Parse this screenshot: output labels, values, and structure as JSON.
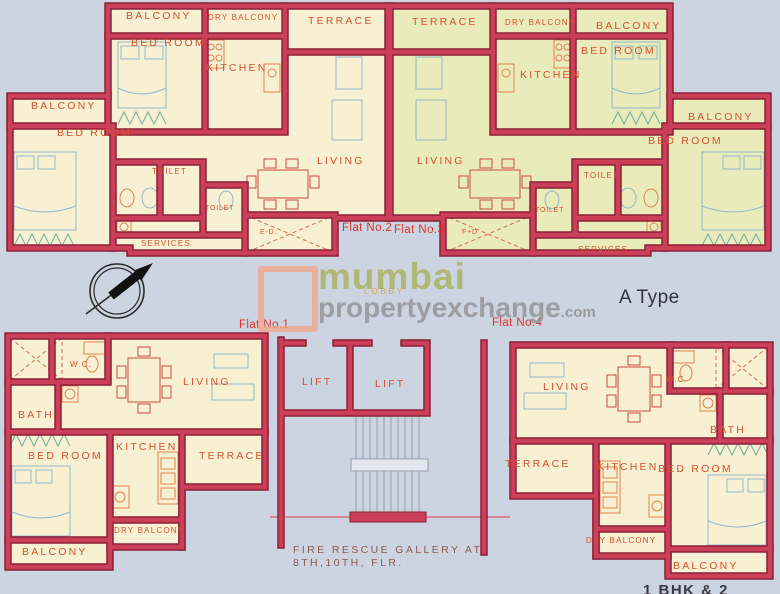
{
  "page": {
    "type_label": "A Type",
    "bottom_caption": "1 BHK & 2",
    "lobby": "LOBBY"
  },
  "watermark": {
    "word1": "mumbai",
    "word2": "propertyexchange",
    "suffix": ".com"
  },
  "core": {
    "lift_left": "LIFT",
    "lift_right": "LIFT",
    "fire_line1": "FIRE RESCUE GALLERY AT",
    "fire_line2": "8TH,10TH, FLR."
  },
  "flats": {
    "flat1": {
      "label": "Flat No.1",
      "wc": "W.C.",
      "living": "LIVING",
      "bath": "BATH",
      "bedroom": "BED ROOM",
      "kitchen": "KITCHEN",
      "terrace": "TERRACE",
      "dry_balcony": "DRY BALCONY",
      "balcony": "BALCONY"
    },
    "flat2": {
      "label": "Flat No.2",
      "balcony_top": "BALCONY",
      "dry_balcony": "DRY BALCONY",
      "terrace": "TERRACE",
      "bedroom_top": "BED ROOM",
      "kitchen": "KITCHEN",
      "balcony_left": "BALCONY",
      "bedroom_left": "BED ROOM",
      "living": "LIVING",
      "toilet1": "TOILET",
      "toilet2": "TOILET",
      "services": "SERVICES",
      "duct": "E-D."
    },
    "flat3": {
      "label": "Flat No.3",
      "terrace": "TERRACE",
      "dry_balcony": "DRY BALCONY",
      "balcony_top": "BALCONY",
      "bedroom_top": "BED ROOM",
      "kitchen": "KITCHEN",
      "balcony_right": "BALCONY",
      "bedroom_right": "BED ROOM",
      "living": "LIVING",
      "toilet1": "TOILET",
      "toilet2": "TOILET",
      "services": "SERVICES",
      "duct": "F+D"
    },
    "flat4": {
      "label": "Flat No.4",
      "living": "LIVING",
      "wc": "W.C",
      "bath": "BATH",
      "terrace": "TERRACE",
      "kitchen": "KITCHEN",
      "bedroom": "BED ROOM",
      "dry_balcony": "DRY BALCONY",
      "balcony": "BALCONY"
    }
  },
  "colors": {
    "wall": "#cb4058",
    "wall_edge": "#8a2136",
    "flat_fill": "#f8f0d3",
    "flat3_fill": "#e9ecba",
    "room_label": "#d8502c",
    "flat_number": "#e0322a",
    "background": "#ccd4e2"
  }
}
